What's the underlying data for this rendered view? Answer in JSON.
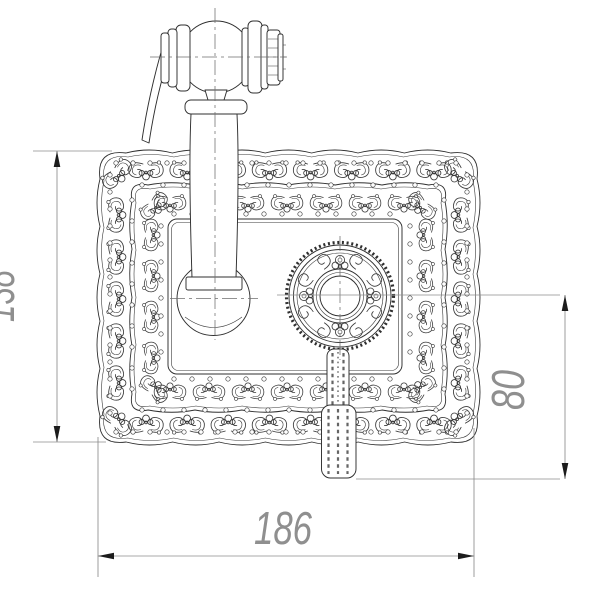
{
  "drawing": {
    "dimension_labels": {
      "plate_height": "138",
      "outlet_drop": "80",
      "plate_width": "186"
    },
    "colors": {
      "ink": "#2f2f2f",
      "ornament": "#3a3a3a",
      "dimension_line": "#8c8c8c",
      "dimension_text": "#8f8f8f",
      "arrow": "#1c1c1c",
      "background": "#ffffff"
    }
  }
}
